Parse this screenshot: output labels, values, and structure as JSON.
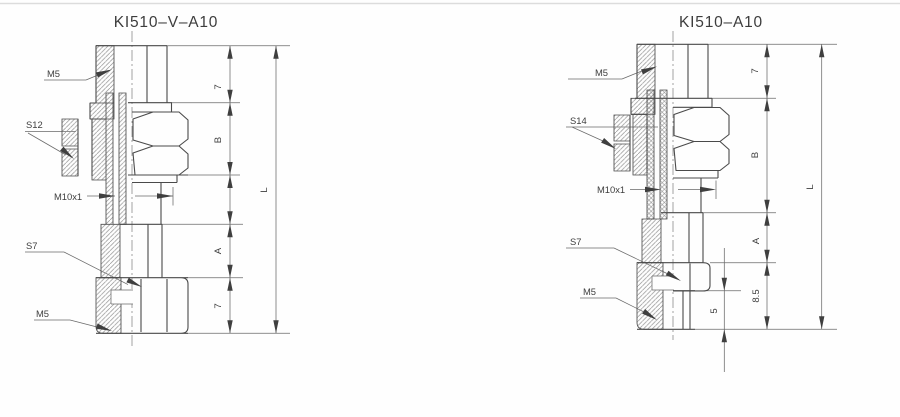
{
  "page": {
    "background": "#fefefe",
    "top_border_color": "#dcdcdc",
    "line_color": "#4a4a4a",
    "text_color": "#3d3d3d"
  },
  "left_drawing": {
    "title": "KI510–V–A10",
    "callouts": {
      "thread_top": "M5",
      "wrench_main": "S12",
      "thread_mid": "M10x1",
      "wrench_lower": "S7",
      "thread_bottom": "M5"
    },
    "dims": {
      "top": "7",
      "hex_height": "B",
      "lower_body": "A",
      "bottom": "7",
      "overall": "L"
    }
  },
  "right_drawing": {
    "title": "KI510–A10",
    "callouts": {
      "thread_top": "M5",
      "wrench_main": "S14",
      "thread_mid": "M10x1",
      "wrench_lower": "S7",
      "thread_bottom": "M5"
    },
    "dims": {
      "top": "7",
      "hex_height": "B",
      "lower_body": "A",
      "bottom": "8.5",
      "nipple": "5",
      "overall": "L"
    }
  }
}
